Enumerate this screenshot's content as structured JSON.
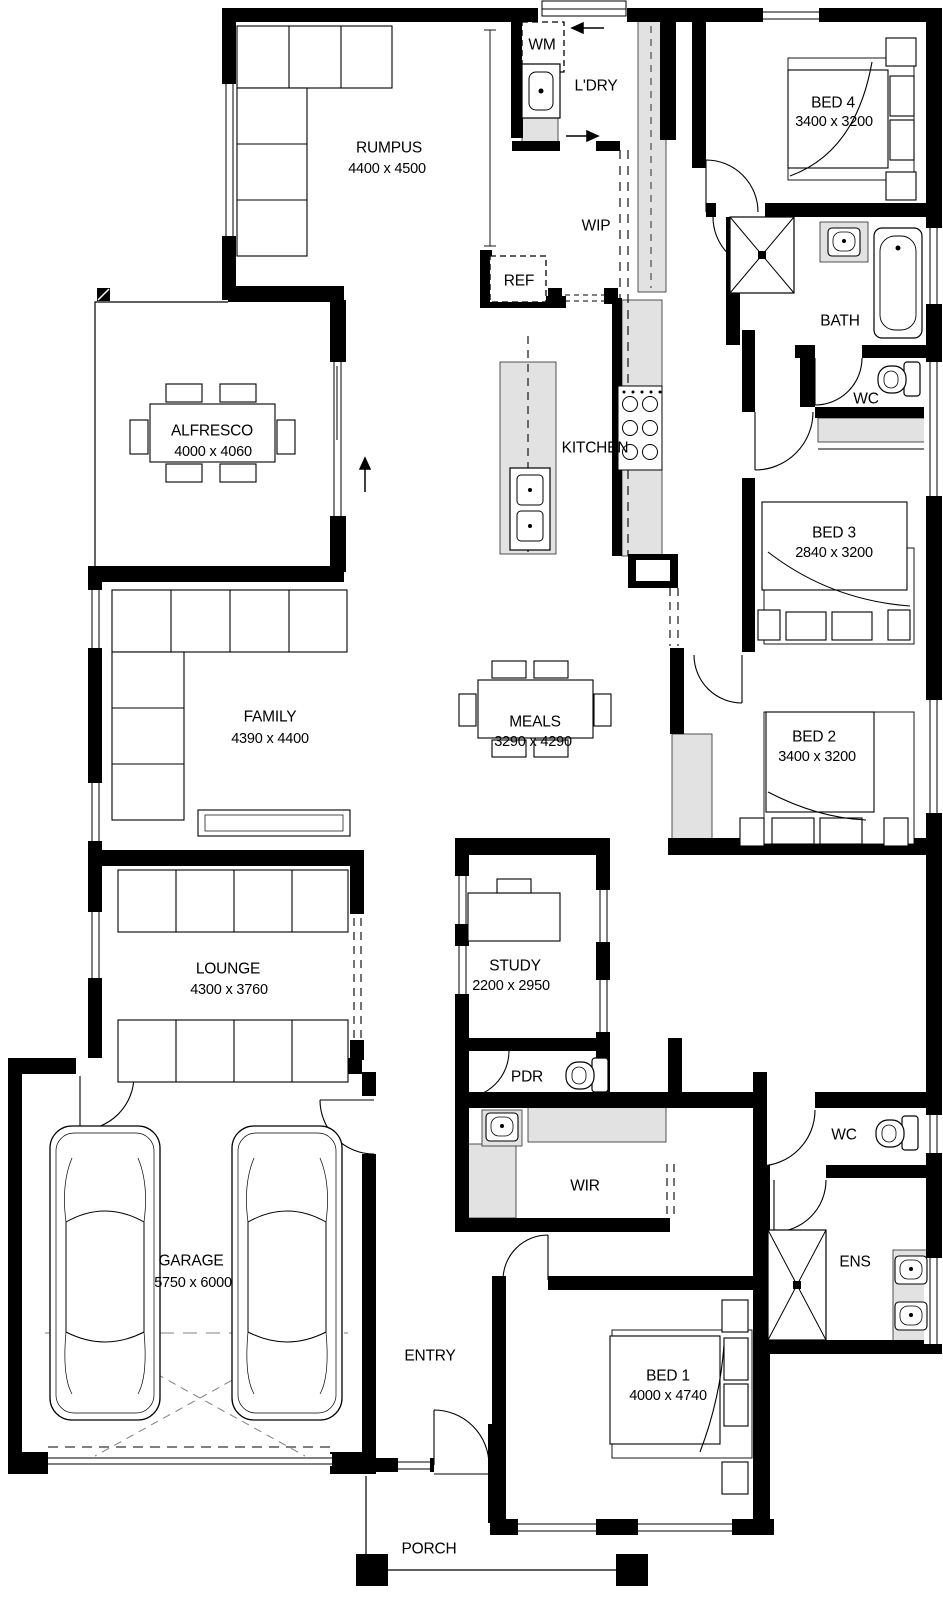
{
  "rooms": {
    "rumpus": {
      "name": "RUMPUS",
      "dims": "4400 x 4500"
    },
    "laundry": {
      "name": "L'DRY"
    },
    "wip": {
      "name": "WIP"
    },
    "bed4": {
      "name": "BED 4",
      "dims": "3400 x 3200"
    },
    "bath": {
      "name": "BATH"
    },
    "wc_top": {
      "name": "WC"
    },
    "alfresco": {
      "name": "ALFRESCO",
      "dims": "4000 x 4060"
    },
    "kitchen": {
      "name": "KITCHEN"
    },
    "bed3": {
      "name": "BED 3",
      "dims": "2840 x 3200"
    },
    "family": {
      "name": "FAMILY",
      "dims": "4390 x 4400"
    },
    "meals": {
      "name": "MEALS",
      "dims": "3290 x 4290"
    },
    "bed2": {
      "name": "BED 2",
      "dims": "3400 x 3200"
    },
    "lounge": {
      "name": "LOUNGE",
      "dims": "4300 x 3760"
    },
    "study": {
      "name": "STUDY",
      "dims": "2200 x 2950"
    },
    "pdr": {
      "name": "PDR"
    },
    "wc_bottom": {
      "name": "WC"
    },
    "wir": {
      "name": "WIR"
    },
    "ens": {
      "name": "ENS"
    },
    "garage": {
      "name": "GARAGE",
      "dims": "5750 x 6000"
    },
    "entry": {
      "name": "ENTRY"
    },
    "bed1": {
      "name": "BED 1",
      "dims": "4000 x 4740"
    },
    "porch": {
      "name": "PORCH"
    }
  },
  "fixtures": {
    "washing_machine": "WM",
    "fridge": "REF"
  }
}
